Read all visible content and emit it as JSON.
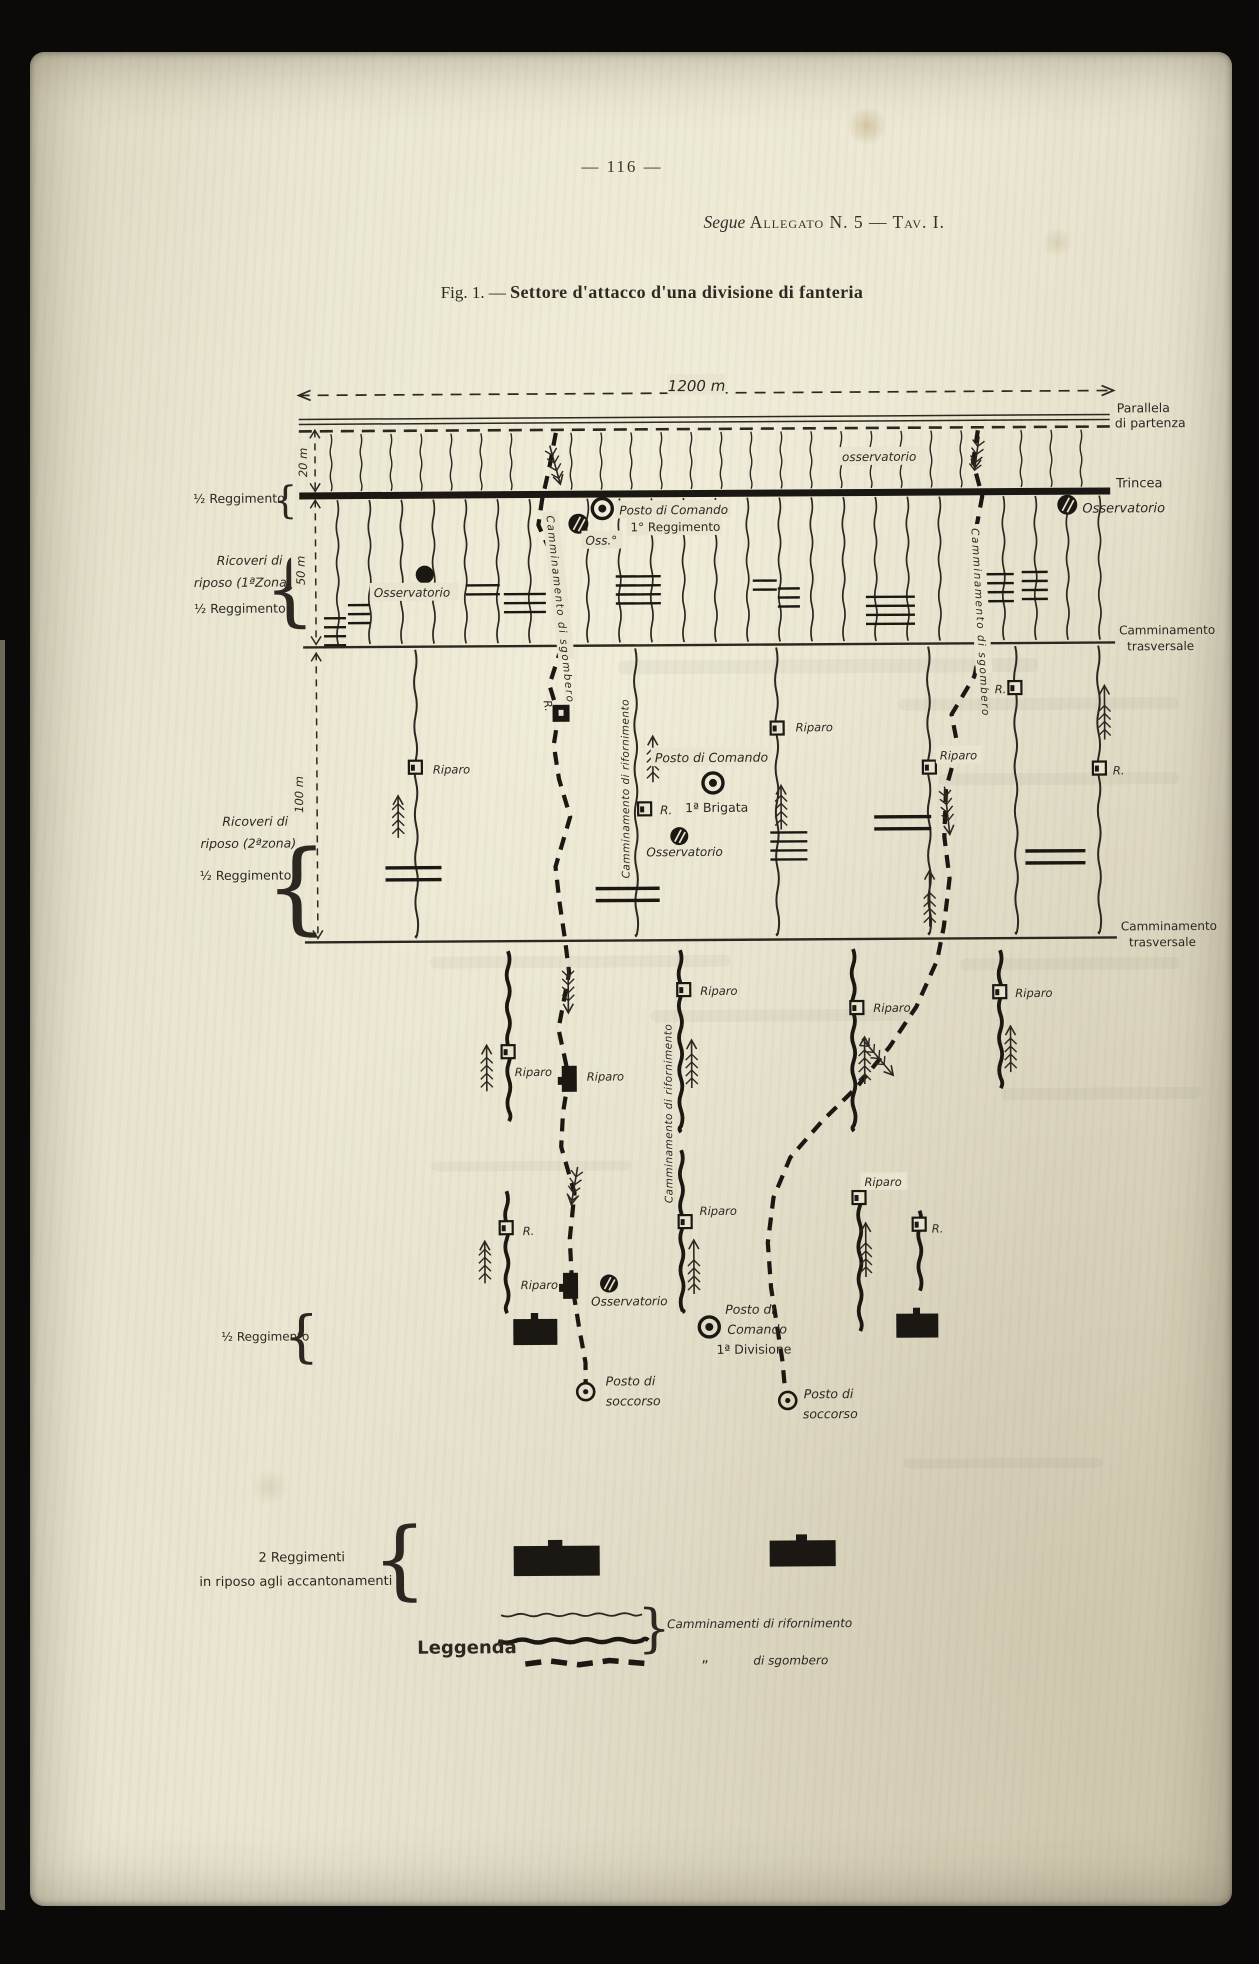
{
  "page": {
    "number": "— 116 —",
    "header_segue": "Segue",
    "header_allegato": "Allegato N. 5 — Tav. I.",
    "figure_prefix": "Fig. 1. —",
    "figure_title": "Settore d'attacco d'una divisione di fanteria"
  },
  "colors": {
    "paper": "#e8e4cf",
    "ink": "#2c2721",
    "heavy_ink": "#1b1813",
    "frame": "#0b0a08"
  },
  "diagram": {
    "labels": [
      {
        "t": "1200 m",
        "x": 700,
        "y": 391,
        "s": 15,
        "i": 1,
        "a": "middle",
        "bg": 1
      },
      {
        "t": "Parallela",
        "x": 1120,
        "y": 415,
        "s": 12.5
      },
      {
        "t": "di partenza",
        "x": 1118,
        "y": 430,
        "s": 12.5
      },
      {
        "t": "osservatorio",
        "x": 845,
        "y": 462,
        "s": 12,
        "i": 1,
        "bg": 1
      },
      {
        "t": "Trincea",
        "x": 1119,
        "y": 490,
        "s": 13
      },
      {
        "t": "Osservatorio",
        "x": 1085,
        "y": 515,
        "s": 13,
        "i": 1
      },
      {
        "t": "½ Reggimento",
        "x": 196,
        "y": 500,
        "s": 12.5
      },
      {
        "t": "20 m",
        "x": 310,
        "y": 460,
        "s": 11.5,
        "i": 1,
        "r": -90,
        "a": "middle",
        "bg": 1
      },
      {
        "t": "50 m",
        "x": 307,
        "y": 568,
        "s": 11.5,
        "i": 1,
        "r": -90,
        "a": "middle",
        "bg": 1
      },
      {
        "t": "100 m",
        "x": 304,
        "y": 792,
        "s": 11.5,
        "i": 1,
        "r": -90,
        "a": "middle",
        "bg": 1
      },
      {
        "t": "Posto di Comando",
        "x": 622,
        "y": 514,
        "s": 12,
        "i": 1,
        "bg": 1
      },
      {
        "t": "1° Reggimento",
        "x": 633,
        "y": 531,
        "s": 12,
        "bg": 1
      },
      {
        "t": "Oss.°",
        "x": 588,
        "y": 544,
        "s": 12,
        "i": 1,
        "bg": 1
      },
      {
        "t": "Osservatorio",
        "x": 376,
        "y": 595,
        "s": 12,
        "i": 1,
        "bg": 1
      },
      {
        "t": "Ricoveri di",
        "x": 252,
        "y": 562,
        "s": 12.5,
        "i": 1,
        "a": "middle"
      },
      {
        "t": "riposo (1ªZona)",
        "x": 245,
        "y": 584,
        "s": 12.5,
        "i": 1,
        "a": "middle"
      },
      {
        "t": "½ Reggimento",
        "x": 242,
        "y": 610,
        "s": 12.5,
        "a": "middle"
      },
      {
        "t": "Camminamento di sgombero",
        "x": 549,
        "y": 515,
        "s": 10.5,
        "i": 1,
        "r": 84,
        "ls": 1.5,
        "bg": 1
      },
      {
        "t": "Camminamento di sgombero",
        "x": 974,
        "y": 530,
        "s": 10.5,
        "i": 1,
        "r": 87,
        "ls": 1.5,
        "bg": 1
      },
      {
        "t": "Camminamento",
        "x": 1121,
        "y": 637,
        "s": 12
      },
      {
        "t": "trasversale",
        "x": 1129,
        "y": 653,
        "s": 12
      },
      {
        "t": "Camminamento",
        "x": 1121,
        "y": 933,
        "s": 12
      },
      {
        "t": "trasversale",
        "x": 1129,
        "y": 949,
        "s": 12
      },
      {
        "t": "Ricoveri di",
        "x": 256,
        "y": 823,
        "s": 12.5,
        "i": 1,
        "a": "middle"
      },
      {
        "t": "riposo (2ªzona)",
        "x": 249,
        "y": 845,
        "s": 12.5,
        "i": 1,
        "a": "middle"
      },
      {
        "t": "½ Reggimento",
        "x": 246,
        "y": 877,
        "s": 12.5,
        "a": "middle"
      },
      {
        "t": "Riparo",
        "x": 434,
        "y": 772,
        "s": 11.5,
        "i": 1
      },
      {
        "t": "Riparo",
        "x": 797,
        "y": 732,
        "s": 11.5,
        "i": 1
      },
      {
        "t": "Riparo",
        "x": 941,
        "y": 761,
        "s": 11.5,
        "i": 1,
        "bg": 1
      },
      {
        "t": "R.",
        "x": 545,
        "y": 700,
        "s": 11,
        "i": 1,
        "r": 80
      },
      {
        "t": "R.",
        "x": 1008,
        "y": 695,
        "s": 11.5,
        "i": 1,
        "a": "end"
      },
      {
        "t": "R.",
        "x": 1114,
        "y": 777,
        "s": 11.5,
        "i": 1
      },
      {
        "t": "Posto di Comando",
        "x": 656,
        "y": 762,
        "s": 12.5,
        "i": 1,
        "bg": 1
      },
      {
        "t": "R.",
        "x": 661,
        "y": 814,
        "s": 12,
        "i": 1
      },
      {
        "t": "1ª Brigata",
        "x": 686,
        "y": 812,
        "s": 12.5
      },
      {
        "t": "Osservatorio",
        "x": 647,
        "y": 856,
        "s": 12,
        "i": 1
      },
      {
        "t": "Camminamento di rifornimento",
        "x": 630,
        "y": 878,
        "s": 10.5,
        "i": 1,
        "r": -90,
        "ls": 0.5
      },
      {
        "t": "Riparo",
        "x": 514,
        "y": 1075,
        "s": 11.5,
        "i": 1
      },
      {
        "t": "Riparo",
        "x": 586,
        "y": 1080,
        "s": 11.5,
        "i": 1
      },
      {
        "t": "Riparo",
        "x": 700,
        "y": 995,
        "s": 11.5,
        "i": 1
      },
      {
        "t": "Riparo",
        "x": 873,
        "y": 1013,
        "s": 11.5,
        "i": 1
      },
      {
        "t": "Riparo",
        "x": 1015,
        "y": 999,
        "s": 11.5,
        "i": 1
      },
      {
        "t": "Camminamento di rifornimento",
        "x": 671,
        "y": 1203,
        "s": 10.5,
        "i": 1,
        "r": -90,
        "ls": 0.5
      },
      {
        "t": "R.",
        "x": 521,
        "y": 1234,
        "s": 11.5,
        "i": 1
      },
      {
        "t": "Riparo",
        "x": 556,
        "y": 1288,
        "s": 11.5,
        "i": 1,
        "a": "end"
      },
      {
        "t": "Osservatorio",
        "x": 589,
        "y": 1305,
        "s": 12,
        "i": 1
      },
      {
        "t": "Riparo",
        "x": 698,
        "y": 1215,
        "s": 11.5,
        "i": 1
      },
      {
        "t": "Riparo",
        "x": 863,
        "y": 1187,
        "s": 11.5,
        "i": 1,
        "bg": 1
      },
      {
        "t": "R.",
        "x": 930,
        "y": 1234,
        "s": 11.5,
        "i": 1
      },
      {
        "t": "Posto di",
        "x": 723,
        "y": 1314,
        "s": 12.5,
        "i": 1
      },
      {
        "t": "Comando",
        "x": 725,
        "y": 1334,
        "s": 12.5,
        "i": 1
      },
      {
        "t": "1ª Divisione",
        "x": 714,
        "y": 1354,
        "s": 12.5
      },
      {
        "t": "Posto di",
        "x": 603,
        "y": 1385,
        "s": 12.5,
        "i": 1
      },
      {
        "t": "soccorso",
        "x": 603,
        "y": 1405,
        "s": 12.5,
        "i": 1
      },
      {
        "t": "Posto di",
        "x": 801,
        "y": 1399,
        "s": 12.5,
        "i": 1
      },
      {
        "t": "soccorso",
        "x": 800,
        "y": 1419,
        "s": 12.5,
        "i": 1
      },
      {
        "t": "½ Reggimento",
        "x": 219,
        "y": 1338,
        "s": 12
      },
      {
        "t": "2 Reggimenti",
        "x": 298,
        "y": 1559,
        "s": 13,
        "a": "middle"
      },
      {
        "t": "in riposo agli accantonamenti",
        "x": 292,
        "y": 1583,
        "s": 13,
        "a": "middle"
      },
      {
        "t": "Leggenda",
        "x": 413,
        "y": 1652,
        "s": 18,
        "b": 1
      },
      {
        "t": "Camminamenti di rifornimento",
        "x": 663,
        "y": 1628,
        "s": 12,
        "i": 1
      },
      {
        "t": "„",
        "x": 697,
        "y": 1662,
        "s": 14
      },
      {
        "t": "di sgombero",
        "x": 749,
        "y": 1665,
        "s": 12,
        "i": 1
      }
    ]
  }
}
